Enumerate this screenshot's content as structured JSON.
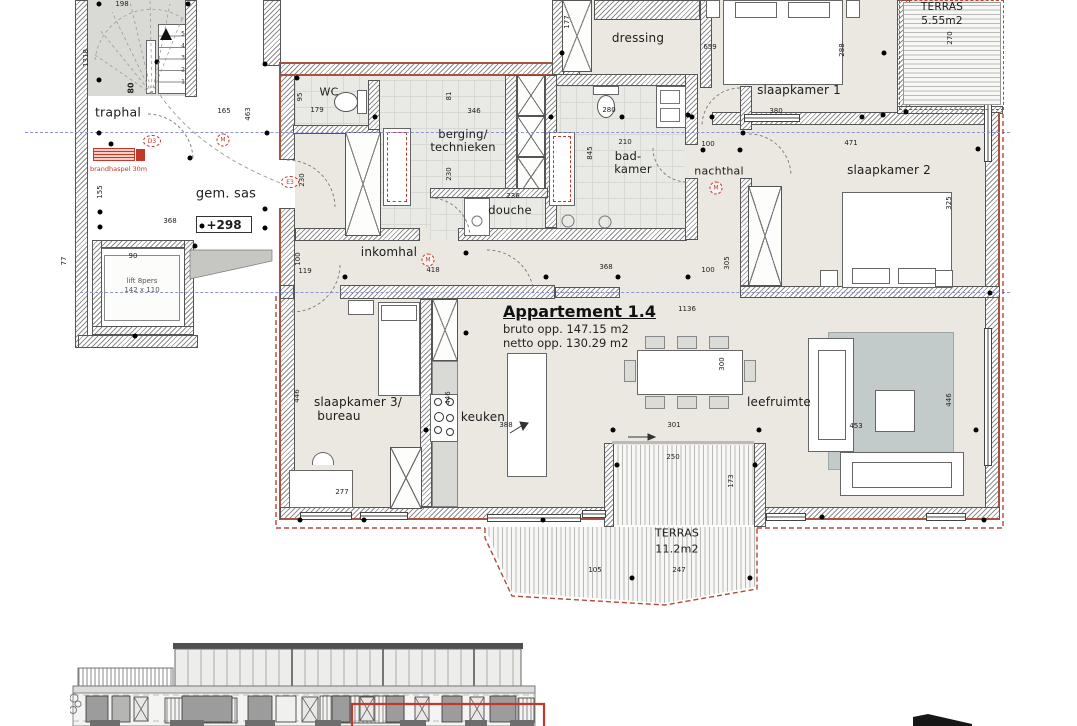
{
  "apartment": {
    "title": "Appartement 1.4",
    "bruto": "bruto opp. 147.15 m2",
    "netto": "netto opp. 130.29 m2"
  },
  "rooms": {
    "traphal": "traphal",
    "gem_sas": "gem. sas",
    "wc": "WC",
    "berging_line1": "berging/",
    "berging_line2": "technieken",
    "douche": "douche",
    "dressing": "dressing",
    "badkamer_line1": "bad-",
    "badkamer_line2": "kamer",
    "nachthal": "nachthal",
    "slaapkamer1": "slaapkamer 1",
    "slaapkamer2": "slaapkamer 2",
    "slaapkamer3_line1": "slaapkamer 3/",
    "slaapkamer3_line2": "bureau",
    "keuken": "keuken",
    "inkomhal": "inkomhal",
    "leefruimte": "leefruimte"
  },
  "terraces": {
    "top": {
      "label": "TERRAS",
      "area": "5.55m2"
    },
    "bottom": {
      "label": "TERRAS",
      "area": "11.2m2"
    }
  },
  "annotations": {
    "level": "+298",
    "lift_line1": "lift 8pers",
    "lift_line2": "142 x 110",
    "fire_hose": "brandhaspel 30m",
    "door_d3": "D3",
    "door_e3": "E3",
    "vent_m": "M",
    "stair_steps": [
      "1",
      "2",
      "3",
      "4",
      "5"
    ]
  },
  "dimensions": [
    "198",
    "1318",
    "80",
    "155",
    "368",
    "165",
    "463",
    "90",
    "77",
    "179",
    "95",
    "230",
    "346",
    "81",
    "230",
    "236",
    "177",
    "659",
    "288",
    "280",
    "380",
    "210",
    "845",
    "100",
    "471",
    "270",
    "325",
    "119",
    "418",
    "100",
    "368",
    "100",
    "305",
    "1136",
    "446",
    "277",
    "446",
    "388",
    "300",
    "301",
    "453",
    "446",
    "250",
    "173",
    "105",
    "247"
  ],
  "colors": {
    "room_fill": "#eae8e1",
    "tile_fill": "#e9e9e6",
    "stair_fill": "#d9d9d5",
    "rug": "#c3cbca",
    "insulation_red": "#a85240",
    "axis_blue": "#8d93d4",
    "annotation_red": "#c0392b"
  }
}
